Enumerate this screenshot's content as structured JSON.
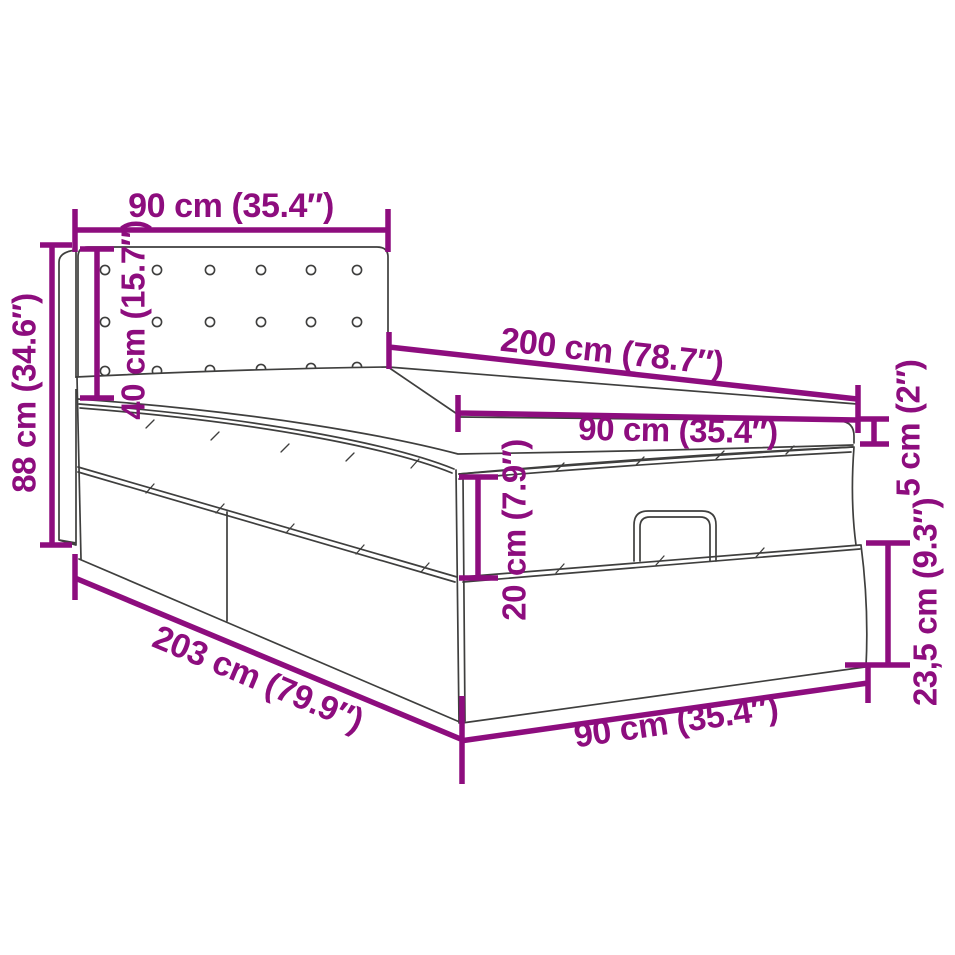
{
  "title": "Ottoman bed dimension diagram",
  "colors": {
    "dimension_accent": "#8D0D7E",
    "outline": "#3F3F3E",
    "background": "#FFFFFF"
  },
  "dimensions": {
    "headboard_width": "90 cm (35.4″)",
    "headboard_height": "40 cm (15.7″)",
    "overall_height": "88 cm (34.6″)",
    "bed_length": "200 cm (78.7″)",
    "mattress_width": "90 cm (35.4″)",
    "topper_thickness": "5 cm (2″)",
    "upper_box_height": "20 cm (7.9″)",
    "base_height": "23,5 cm (9.3″)",
    "overall_length": "203 cm (79.9″)",
    "base_width": "90 cm (35.4″)"
  }
}
